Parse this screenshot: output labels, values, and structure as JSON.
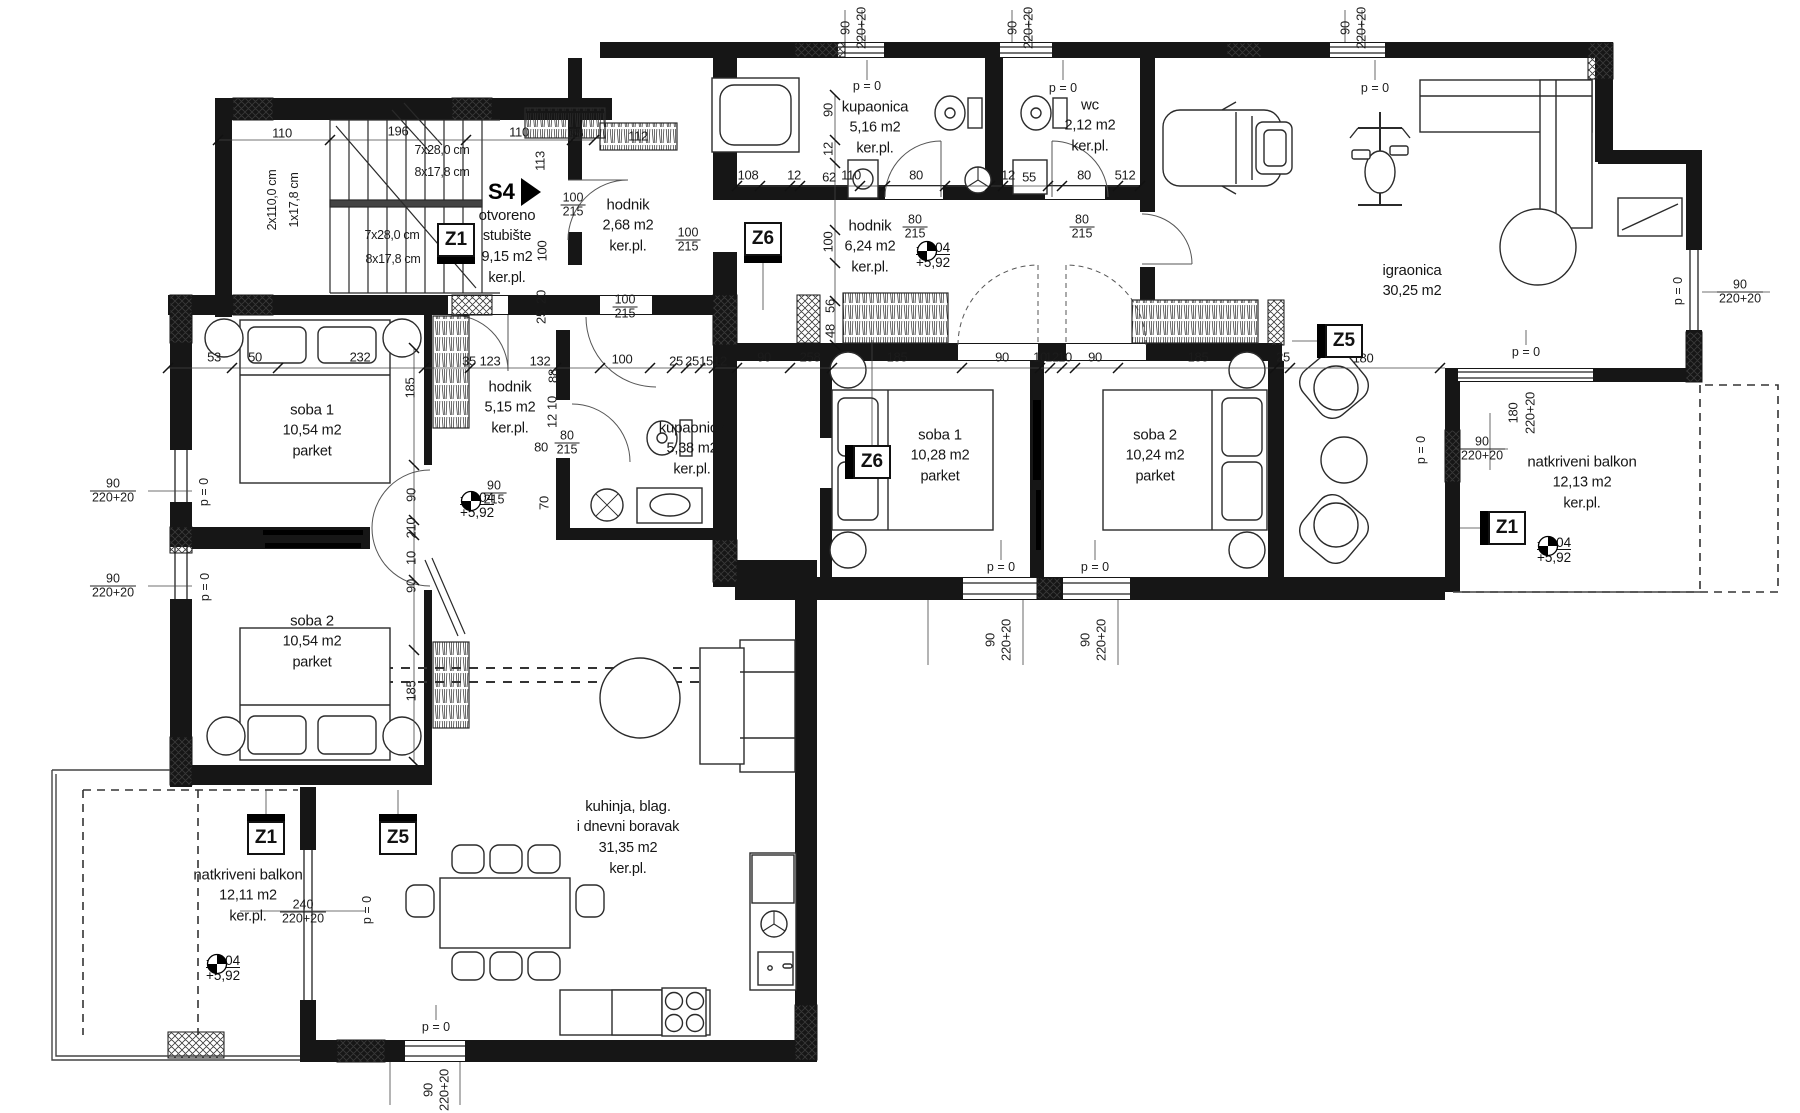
{
  "drawing": {
    "unit": {
      "label": "S4",
      "x": 488,
      "y": 192
    },
    "rooms": [
      {
        "lines": [
          "otvoreno",
          "stubište",
          "9,15 m2",
          "ker.pl."
        ],
        "x": 507,
        "y": 247
      },
      {
        "lines": [
          "hodnik",
          "2,68 m2",
          "ker.pl."
        ],
        "x": 628,
        "y": 226
      },
      {
        "lines": [
          "kupaonica",
          "5,16 m2",
          "ker.pl."
        ],
        "x": 875,
        "y": 128
      },
      {
        "lines": [
          "wc",
          "2,12 m2",
          "ker.pl."
        ],
        "x": 1090,
        "y": 126
      },
      {
        "lines": [
          "hodnik",
          "6,24 m2",
          "ker.pl."
        ],
        "x": 870,
        "y": 247
      },
      {
        "lines": [
          "igraonica",
          "30,25 m2"
        ],
        "x": 1412,
        "y": 281
      },
      {
        "lines": [
          "soba 1",
          "10,28 m2",
          "parket"
        ],
        "x": 940,
        "y": 456
      },
      {
        "lines": [
          "soba 2",
          "10,24 m2",
          "parket"
        ],
        "x": 1155,
        "y": 456
      },
      {
        "lines": [
          "natkriveni balkon",
          "12,13 m2",
          "ker.pl."
        ],
        "x": 1582,
        "y": 483
      },
      {
        "lines": [
          "soba 1",
          "10,54 m2",
          "parket"
        ],
        "x": 312,
        "y": 431
      },
      {
        "lines": [
          "soba 2",
          "10,54 m2",
          "parket"
        ],
        "x": 312,
        "y": 642
      },
      {
        "lines": [
          "hodnik",
          "5,15 m2",
          "ker.pl."
        ],
        "x": 510,
        "y": 408
      },
      {
        "lines": [
          "kupaonica",
          "5,38 m2",
          "ker.pl."
        ],
        "x": 692,
        "y": 449
      },
      {
        "lines": [
          "kuhinja, blag.",
          "i dnevni boravak",
          "31,35 m2",
          "ker.pl."
        ],
        "x": 628,
        "y": 838
      },
      {
        "lines": [
          "natkriveni balkon",
          "12,11 m2",
          "ker.pl."
        ],
        "x": 248,
        "y": 896
      }
    ],
    "markers": [
      {
        "label": "Z1",
        "x": 456,
        "y": 240,
        "tab": "b"
      },
      {
        "label": "Z6",
        "x": 763,
        "y": 239,
        "tab": "b"
      },
      {
        "label": "Z6",
        "x": 872,
        "y": 462,
        "tab": "l"
      },
      {
        "label": "Z5",
        "x": 1344,
        "y": 341,
        "tab": "l"
      },
      {
        "label": "Z1",
        "x": 1507,
        "y": 528,
        "tab": "l"
      },
      {
        "label": "Z1",
        "x": 266,
        "y": 838,
        "tab": "t"
      },
      {
        "label": "Z5",
        "x": 398,
        "y": 838,
        "tab": "t"
      }
    ],
    "levels": [
      {
        "upper": "+6,04",
        "lower": "+5,92",
        "x": 916,
        "y": 255
      },
      {
        "upper": "+6,04",
        "lower": "+5,92",
        "x": 460,
        "y": 505
      },
      {
        "upper": "+6,04",
        "lower": "+5,92",
        "x": 1537,
        "y": 550
      },
      {
        "upper": "+6,04",
        "lower": "+5,92",
        "x": 206,
        "y": 968
      }
    ],
    "p0_text": "p = 0",
    "p0": [
      {
        "x": 867,
        "y": 86,
        "v": 0
      },
      {
        "x": 1063,
        "y": 88,
        "v": 0
      },
      {
        "x": 1375,
        "y": 88,
        "v": 0
      },
      {
        "x": 1526,
        "y": 352,
        "v": 0
      },
      {
        "x": 436,
        "y": 1027,
        "v": 0
      },
      {
        "x": 1001,
        "y": 567,
        "v": 0
      },
      {
        "x": 1095,
        "y": 567,
        "v": 0
      },
      {
        "x": 204,
        "y": 492,
        "v": 1
      },
      {
        "x": 205,
        "y": 587,
        "v": 1
      },
      {
        "x": 367,
        "y": 910,
        "v": 1
      },
      {
        "x": 1421,
        "y": 450,
        "v": 1
      },
      {
        "x": 1678,
        "y": 291,
        "v": 1
      }
    ],
    "dims": [
      {
        "t": "110",
        "x": 282,
        "y": 133
      },
      {
        "t": "196",
        "x": 398,
        "y": 131
      },
      {
        "t": "110",
        "x": 519,
        "y": 132
      },
      {
        "t": "25",
        "x": 576,
        "y": 133
      },
      {
        "t": "7x28,0 cm",
        "x": 442,
        "y": 150,
        "s": 1
      },
      {
        "t": "8x17,8 cm",
        "x": 442,
        "y": 172,
        "s": 1
      },
      {
        "t": "2x110,0 cm",
        "x": 272,
        "y": 200,
        "v": 1,
        "s": 1
      },
      {
        "t": "1x17,8 cm",
        "x": 294,
        "y": 200,
        "v": 1,
        "s": 1
      },
      {
        "t": "7x28,0 cm",
        "x": 392,
        "y": 235,
        "s": 1
      },
      {
        "t": "8x17,8 cm",
        "x": 393,
        "y": 259,
        "s": 1
      },
      {
        "t": "113",
        "x": 540,
        "y": 161,
        "v": 1
      },
      {
        "t": "100",
        "x": 542,
        "y": 251,
        "v": 1
      },
      {
        "t": "112",
        "x": 638,
        "y": 136
      },
      {
        "t": "20",
        "x": 541,
        "y": 297,
        "v": 1
      },
      {
        "t": "25",
        "x": 541,
        "y": 317,
        "v": 1
      },
      {
        "t": "90",
        "x": 845,
        "y": 28,
        "v": 1
      },
      {
        "t": "220+20",
        "x": 861,
        "y": 28,
        "v": 1
      },
      {
        "t": "90",
        "x": 1012,
        "y": 28,
        "v": 1
      },
      {
        "t": "220+20",
        "x": 1028,
        "y": 28,
        "v": 1
      },
      {
        "t": "90",
        "x": 1345,
        "y": 28,
        "v": 1
      },
      {
        "t": "220+20",
        "x": 1361,
        "y": 28,
        "v": 1
      },
      {
        "t": "90",
        "x": 828,
        "y": 110,
        "v": 1
      },
      {
        "t": "12",
        "x": 828,
        "y": 149,
        "v": 1
      },
      {
        "t": "108",
        "x": 748,
        "y": 175
      },
      {
        "t": "12",
        "x": 794,
        "y": 175
      },
      {
        "t": "62",
        "x": 829,
        "y": 177
      },
      {
        "t": "110",
        "x": 851,
        "y": 175
      },
      {
        "t": "80",
        "x": 916,
        "y": 175
      },
      {
        "t": "12",
        "x": 1008,
        "y": 175
      },
      {
        "t": "55",
        "x": 1029,
        "y": 177
      },
      {
        "t": "80",
        "x": 1084,
        "y": 175
      },
      {
        "t": "512",
        "x": 1125,
        "y": 175
      },
      {
        "t": "100",
        "x": 828,
        "y": 242,
        "v": 1
      },
      {
        "t": "56",
        "x": 830,
        "y": 306,
        "v": 1
      },
      {
        "t": "48",
        "x": 830,
        "y": 331,
        "v": 1
      },
      {
        "t": "53",
        "x": 214,
        "y": 357
      },
      {
        "t": "50",
        "x": 255,
        "y": 357
      },
      {
        "t": "232",
        "x": 360,
        "y": 357
      },
      {
        "t": "35",
        "x": 469,
        "y": 361
      },
      {
        "t": "123",
        "x": 490,
        "y": 361
      },
      {
        "t": "132",
        "x": 540,
        "y": 361
      },
      {
        "t": "100",
        "x": 622,
        "y": 359
      },
      {
        "t": "25",
        "x": 676,
        "y": 361
      },
      {
        "t": "25",
        "x": 692,
        "y": 361
      },
      {
        "t": "15",
        "x": 706,
        "y": 361
      },
      {
        "t": "12",
        "x": 720,
        "y": 361
      },
      {
        "t": "90",
        "x": 764,
        "y": 357
      },
      {
        "t": "258",
        "x": 810,
        "y": 357
      },
      {
        "t": "185",
        "x": 897,
        "y": 357
      },
      {
        "t": "90",
        "x": 1002,
        "y": 357
      },
      {
        "t": "10",
        "x": 1040,
        "y": 357
      },
      {
        "t": "12",
        "x": 1052,
        "y": 357
      },
      {
        "t": "10",
        "x": 1065,
        "y": 357
      },
      {
        "t": "90",
        "x": 1095,
        "y": 357
      },
      {
        "t": "185",
        "x": 1198,
        "y": 357
      },
      {
        "t": "25",
        "x": 1283,
        "y": 357
      },
      {
        "t": "180",
        "x": 1363,
        "y": 358
      },
      {
        "t": "185",
        "x": 410,
        "y": 388,
        "v": 1
      },
      {
        "t": "90",
        "x": 411,
        "y": 495,
        "v": 1
      },
      {
        "t": "210",
        "x": 411,
        "y": 528,
        "v": 1
      },
      {
        "t": "10",
        "x": 411,
        "y": 558,
        "v": 1
      },
      {
        "t": "90",
        "x": 411,
        "y": 586,
        "v": 1
      },
      {
        "t": "185",
        "x": 411,
        "y": 691,
        "v": 1
      },
      {
        "t": "70",
        "x": 544,
        "y": 503,
        "v": 1
      },
      {
        "t": "88",
        "x": 553,
        "y": 376,
        "v": 1
      },
      {
        "t": "10",
        "x": 552,
        "y": 403,
        "v": 1
      },
      {
        "t": "12",
        "x": 552,
        "y": 421,
        "v": 1
      },
      {
        "t": "80",
        "x": 541,
        "y": 447
      },
      {
        "t": "90",
        "x": 990,
        "y": 640,
        "v": 1
      },
      {
        "t": "220+20",
        "x": 1006,
        "y": 640,
        "v": 1
      },
      {
        "t": "90",
        "x": 1085,
        "y": 640,
        "v": 1
      },
      {
        "t": "220+20",
        "x": 1101,
        "y": 640,
        "v": 1
      },
      {
        "t": "180",
        "x": 1513,
        "y": 413,
        "v": 1
      },
      {
        "t": "220+20",
        "x": 1530,
        "y": 413,
        "v": 1
      },
      {
        "t": "90",
        "x": 428,
        "y": 1090,
        "v": 1
      },
      {
        "t": "220+20",
        "x": 444,
        "y": 1090,
        "v": 1
      }
    ],
    "fracs": [
      {
        "top": "100",
        "bot": "215",
        "x": 573,
        "y": 205
      },
      {
        "top": "100",
        "bot": "215",
        "x": 688,
        "y": 240
      },
      {
        "top": "100",
        "bot": "215",
        "x": 625,
        "y": 307
      },
      {
        "top": "80",
        "bot": "215",
        "x": 567,
        "y": 443
      },
      {
        "top": "90",
        "bot": "215",
        "x": 494,
        "y": 493
      },
      {
        "top": "80",
        "bot": "215",
        "x": 915,
        "y": 227
      },
      {
        "top": "80",
        "bot": "215",
        "x": 1082,
        "y": 227
      },
      {
        "top": "90",
        "bot": "220+20",
        "x": 113,
        "y": 491
      },
      {
        "top": "90",
        "bot": "220+20",
        "x": 113,
        "y": 586
      },
      {
        "top": "90",
        "bot": "220+20",
        "x": 1482,
        "y": 449
      },
      {
        "top": "90",
        "bot": "220+20",
        "x": 1740,
        "y": 292
      },
      {
        "top": "240",
        "bot": "220+20",
        "x": 303,
        "y": 912
      }
    ]
  }
}
